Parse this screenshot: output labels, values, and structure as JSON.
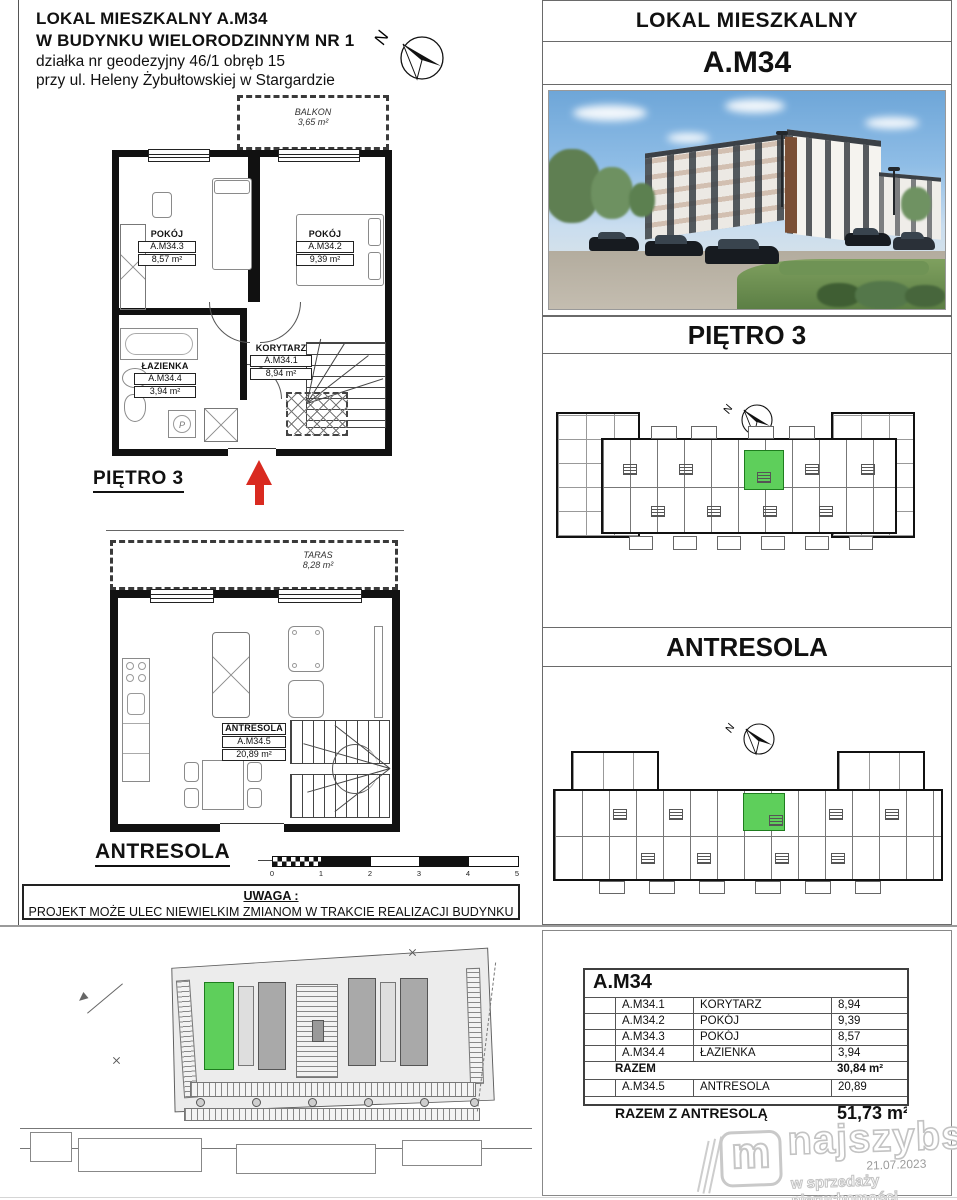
{
  "header": {
    "line1": "LOKAL MIESZKALNY  A.M34",
    "line2": "W BUDYNKU WIELORODZINNYM NR 1",
    "line3": "działka nr geodezyjny 46/1 obręb 15",
    "line4": "przy ul. Heleny Żybułtowskiej w Stargardzie"
  },
  "compass": {
    "label": "N"
  },
  "plan_pietro3": {
    "balcony": {
      "name": "BALKON",
      "area": "3,65 m²"
    },
    "room_a": {
      "name": "POKÓJ",
      "id": "A.M34.3",
      "area": "8,57 m²"
    },
    "room_b": {
      "name": "POKÓJ",
      "id": "A.M34.2",
      "area": "9,39 m²"
    },
    "bathroom": {
      "name": "ŁAZIENKA",
      "id": "A.M34.4",
      "area": "3,94 m²"
    },
    "corridor": {
      "name": "KORYTARZ",
      "id": "A.M34.1",
      "area": "8,94 m²"
    },
    "washer_label": "P",
    "floor_label": "PIĘTRO 3"
  },
  "plan_antresola": {
    "terrace": {
      "name": "TARAS",
      "area": "8,28 m²"
    },
    "room": {
      "name": "ANTRESOLA",
      "id": "A.M34.5",
      "area": "20,89 m²"
    },
    "floor_label": "ANTRESOLA"
  },
  "scale_bar": {
    "ticks": [
      "0",
      "1",
      "2",
      "3",
      "4",
      "5"
    ]
  },
  "notice": {
    "title": "UWAGA :",
    "text": "PROJEKT MOŻE ULEC NIEWIELKIM ZMIANOM W TRAKCIE REALIZACJI BUDYNKU"
  },
  "right_panel": {
    "title": "LOKAL MIESZKALNY",
    "unit": "A.M34",
    "floor1": "PIĘTRO 3",
    "floor2": "ANTRESOLA"
  },
  "area_table": {
    "title": "A.M34",
    "rows": [
      {
        "id": "A.M34.1",
        "name": "KORYTARZ",
        "area": "8,94"
      },
      {
        "id": "A.M34.2",
        "name": "POKÓJ",
        "area": "9,39"
      },
      {
        "id": "A.M34.3",
        "name": "POKÓJ",
        "area": "8,57"
      },
      {
        "id": "A.M34.4",
        "name": "ŁAZIENKA",
        "area": "3,94"
      }
    ],
    "subtotal": {
      "label": "RAZEM",
      "value": "30,84 m²"
    },
    "mezzanine": {
      "id": "A.M34.5",
      "name": "ANTRESOLA",
      "area": "20,89"
    },
    "total": {
      "label": "RAZEM Z ANTRESOLĄ",
      "value": "51,73 m²"
    }
  },
  "watermark": {
    "icon": "m",
    "brand": "najszybsi",
    "tagline": "w sprzedaży nieruchomości",
    "date": "21.07.2023"
  },
  "colors": {
    "highlight_green": "#5ecf5b",
    "arrow_red": "#d92a20"
  }
}
